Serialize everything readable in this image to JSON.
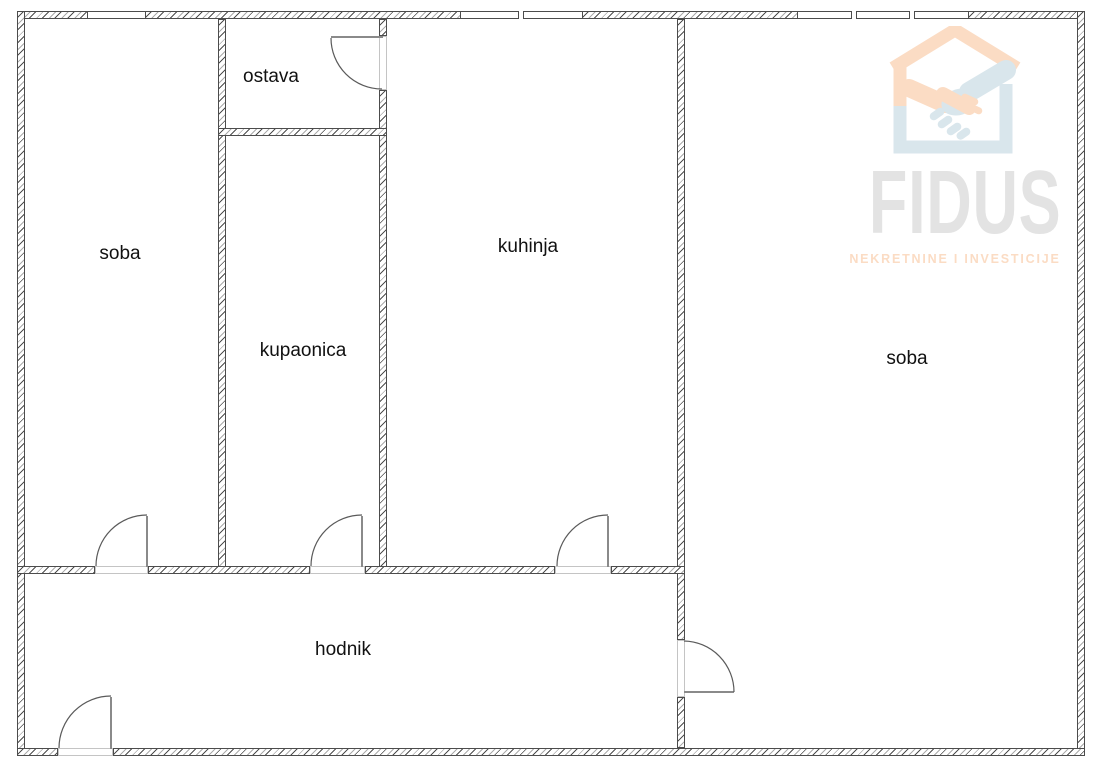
{
  "floorplan": {
    "rooms": [
      {
        "id": "soba-left",
        "label": "soba"
      },
      {
        "id": "ostava",
        "label": "ostava"
      },
      {
        "id": "kupaonica",
        "label": "kupaonica"
      },
      {
        "id": "kuhinja",
        "label": "kuhinja"
      },
      {
        "id": "soba-right",
        "label": "soba"
      },
      {
        "id": "hodnik",
        "label": "hodnik"
      }
    ],
    "line_color": "#4c4c4c"
  },
  "watermark": {
    "brand": "FIDUS",
    "tagline": "NEKRETNINE I INVESTICIJE",
    "colors": {
      "brand_gray": "#e3e3e3",
      "peach": "#fbdcc4",
      "blue": "#d9e6ec"
    }
  }
}
